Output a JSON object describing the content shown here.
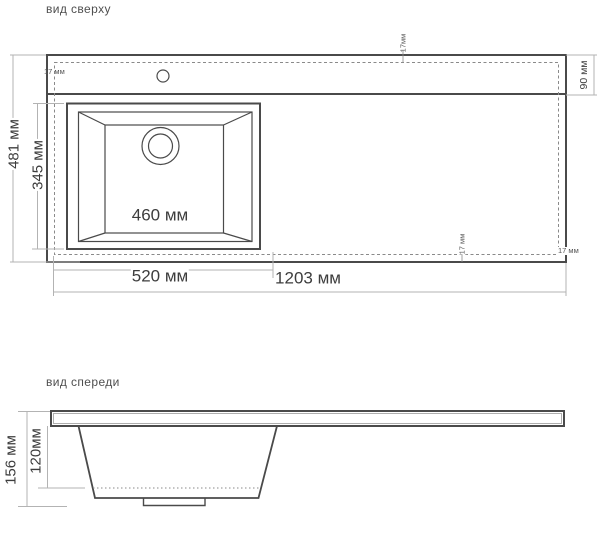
{
  "top_view": {
    "title": "вид сверху",
    "dimensions": {
      "overall_length": "1203 мм",
      "overall_depth": "481 мм",
      "cutout_width": "520 мм",
      "bowl_width": "460 мм",
      "bowl_depth": "345 мм",
      "rear_deck_depth": "90 мм",
      "edge_offset_left": "17 мм",
      "edge_offset_top": "17мм",
      "edge_offset_bottom": "17 мм",
      "edge_offset_right": "17 мм"
    }
  },
  "front_view": {
    "title": "вид спереди",
    "dimensions": {
      "overall_height": "156 мм",
      "bowl_height": "120мм"
    }
  },
  "colors": {
    "drawing_line": "#4a4a4a",
    "dimension_line": "#b3b3b3",
    "dashed_line": "#8a8a8a",
    "text": "#3d3d3d"
  }
}
